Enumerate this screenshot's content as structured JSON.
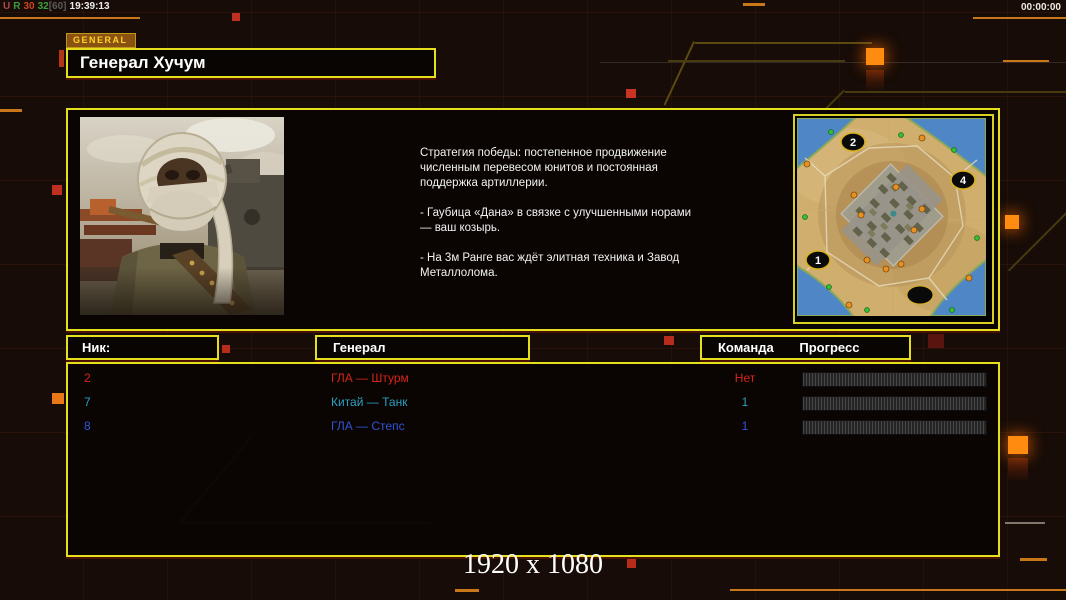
{
  "status_bar": {
    "segments": [
      {
        "text": "U",
        "color": "#b04848"
      },
      {
        "text": "R",
        "color": "#3f9a3f"
      },
      {
        "text": "30",
        "color": "#d2421e"
      },
      {
        "text": "32",
        "color": "#3fa03f"
      },
      {
        "text": "[60]",
        "color": "#5a5a5a"
      },
      {
        "text": "19:39:13",
        "color": "#ececec"
      }
    ],
    "timer": "00:00:00"
  },
  "header": {
    "tab_label": "GENERAL",
    "title": "Генерал Хучум"
  },
  "briefing": {
    "paragraphs": [
      "Стратегия победы: постепенное продвижение численным перевесом юнитов и постоянная поддержка артиллерии.",
      "- Гаубица «Дана» в связке с улучшенными норами — ваш козырь.",
      "- На 3м Ранге вас ждёт элитная техника и Завод Металлолома."
    ]
  },
  "minimap": {
    "markers": [
      {
        "label": "2",
        "x": 56,
        "y": 24
      },
      {
        "label": "4",
        "x": 166,
        "y": 62
      },
      {
        "label": "1",
        "x": 21,
        "y": 142
      },
      {
        "label": "",
        "x": 123,
        "y": 177
      }
    ]
  },
  "table": {
    "columns": {
      "nick": "Ник:",
      "general": "Генерал",
      "team": "Команда",
      "progress": "Прогресс"
    },
    "rows": [
      {
        "nick": "2",
        "general": "ГЛА — Штурм",
        "team": "Нет",
        "color": "#d62518",
        "progress": 0
      },
      {
        "nick": "7",
        "general": "Китай — Танк",
        "team": "1",
        "color": "#2c9fc2",
        "progress": 0
      },
      {
        "nick": "8",
        "general": "ГЛА — Степс",
        "team": "1",
        "color": "#3353d6",
        "progress": 0
      }
    ]
  },
  "footer": {
    "resolution_label": "1920 x 1080"
  },
  "colors": {
    "accent_yellow": "#e6df1e",
    "trace_orange": "#c87818",
    "glow_orange": "#ff8c10"
  }
}
